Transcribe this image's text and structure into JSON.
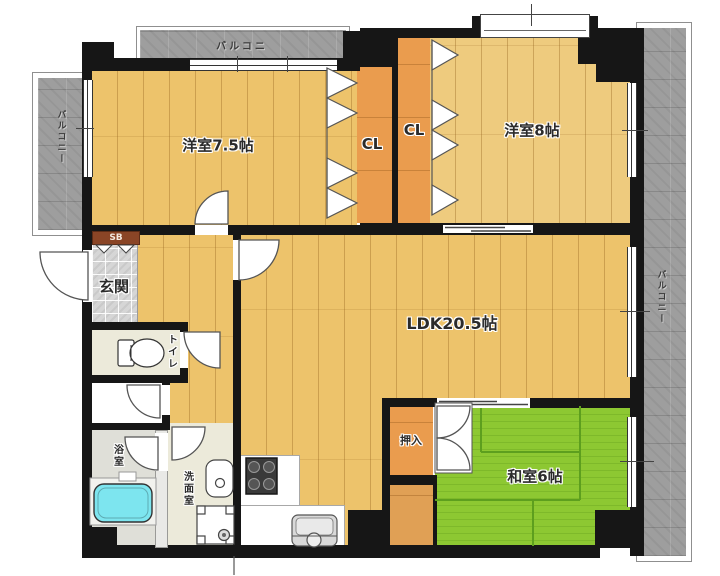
{
  "plan_title": "apartment-floor-plan",
  "rooms": {
    "western1": {
      "label": "洋室7.5帖"
    },
    "western2": {
      "label": "洋室8帖"
    },
    "ldk": {
      "label": "LDK20.5帖"
    },
    "japanese": {
      "label": "和室6帖"
    },
    "closet1": {
      "label": "CL"
    },
    "closet2": {
      "label": "CL"
    },
    "oshiire": {
      "label": "押入"
    },
    "genkan": {
      "label": "玄関"
    },
    "toilet": {
      "label": "トイレ"
    },
    "bath": {
      "label": "浴室"
    },
    "washroom": {
      "label": "洗面室"
    },
    "shoebox": {
      "label": "SB"
    }
  },
  "balconies": {
    "top": {
      "label": "バルコニ"
    },
    "left": {
      "label": "バルコニー"
    },
    "right": {
      "label": "バルコニー"
    }
  },
  "colors": {
    "wall": "#161616",
    "wood_floor": "#edc36b",
    "closet_floor": "#ea9c4e",
    "tatami": "#8dc832",
    "balcony": "#9e9e9e",
    "bathtub": "#7de5ef",
    "shoebox": "#8a4526"
  }
}
